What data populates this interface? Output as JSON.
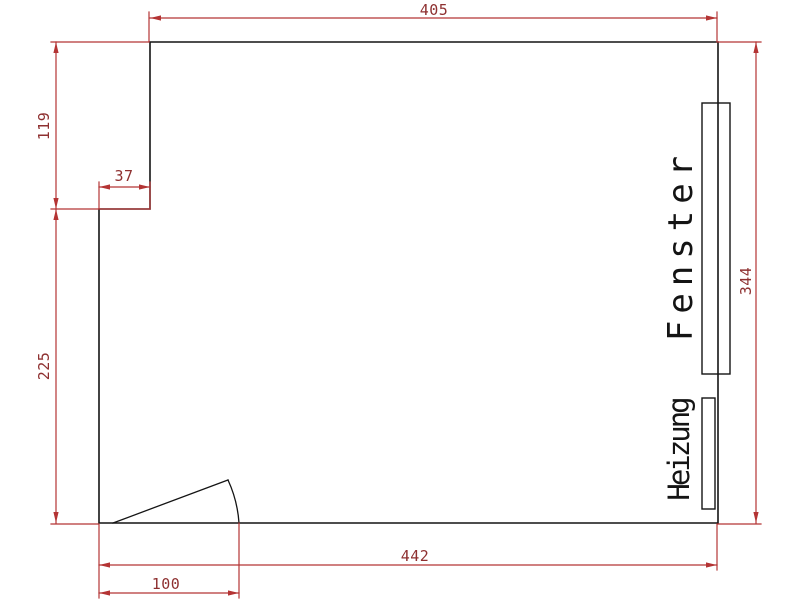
{
  "drawing": {
    "labels": {
      "window": "Fenster",
      "heater": "Heizung"
    },
    "dimensions": {
      "top_width": "405",
      "left_upper_height": "119",
      "wall_step": "37",
      "left_lower_height": "225",
      "right_height": "344",
      "bottom_width": "442",
      "door_opening": "100"
    },
    "colors": {
      "dimension_line": "#b43434",
      "dimension_text": "#8e3030",
      "geometry": "#141414",
      "background": "#ffffff"
    }
  }
}
